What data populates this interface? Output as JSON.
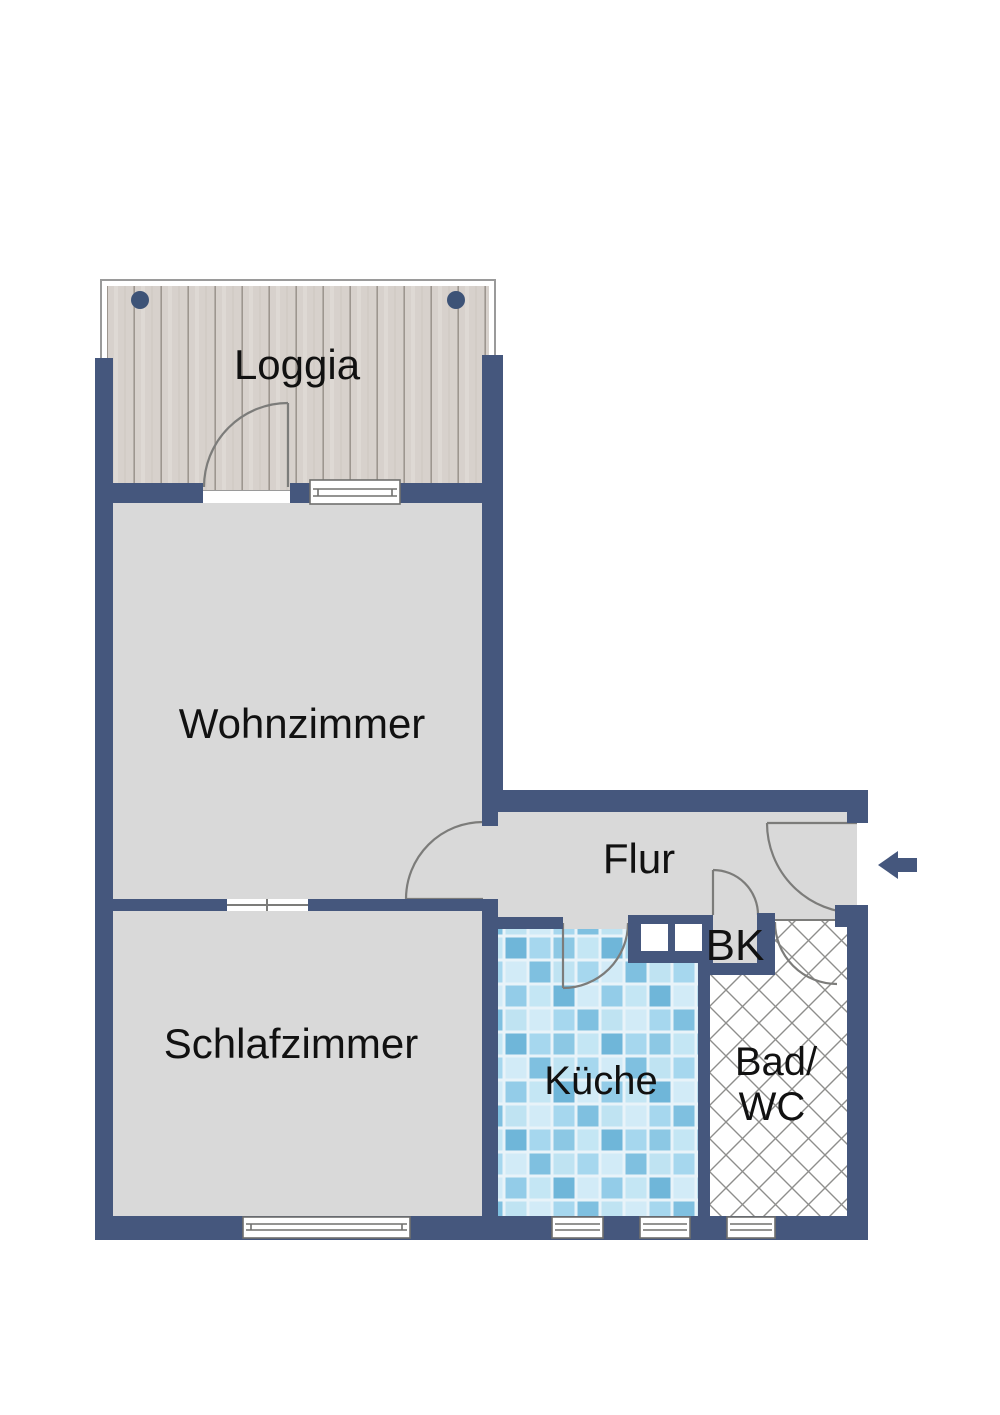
{
  "plan": {
    "type": "apartment-floor-plan",
    "rooms": {
      "loggia": {
        "label": "Loggia",
        "floor_finish": "wood-planks"
      },
      "wohnzimmer": {
        "label": "Wohnzimmer",
        "floor_finish": "plain-gray"
      },
      "schlafzimmer": {
        "label": "Schlafzimmer",
        "floor_finish": "plain-gray"
      },
      "flur": {
        "label": "Flur",
        "floor_finish": "plain-gray"
      },
      "kueche": {
        "label": "Küche",
        "floor_finish": "blue-mosaic-tiles"
      },
      "bad": {
        "label_line1": "Bad/",
        "label_line2": "WC",
        "floor_finish": "crosshatch-tiles"
      },
      "bk": {
        "label": "BK"
      }
    },
    "symbols": {
      "entrance_arrow": {
        "name": "entrance-arrow",
        "direction": "left"
      },
      "shaft": {
        "name": "installation-shaft",
        "cells": 2
      },
      "pins": {
        "name": "mounting-pin",
        "count": 2
      },
      "windows": {
        "count": 5
      },
      "door_arcs": {
        "count": 6
      }
    },
    "colors": {
      "wall": "#45577d",
      "floor_gray": "#d9d9d9",
      "wood_base": "#d7d1cc",
      "wood_line": "#9d968f",
      "tile_grout": "#e8f3f9",
      "tile_blue_dark": "#6fb6d9",
      "tile_blue_mid": "#a6d7ee",
      "tile_blue_light": "#d2ebf7",
      "hatch_line": "#8e8e8c",
      "door_arc": "#7c7c7a",
      "pin": "#3d5377",
      "label_text": "#111111",
      "background": "#ffffff"
    }
  }
}
